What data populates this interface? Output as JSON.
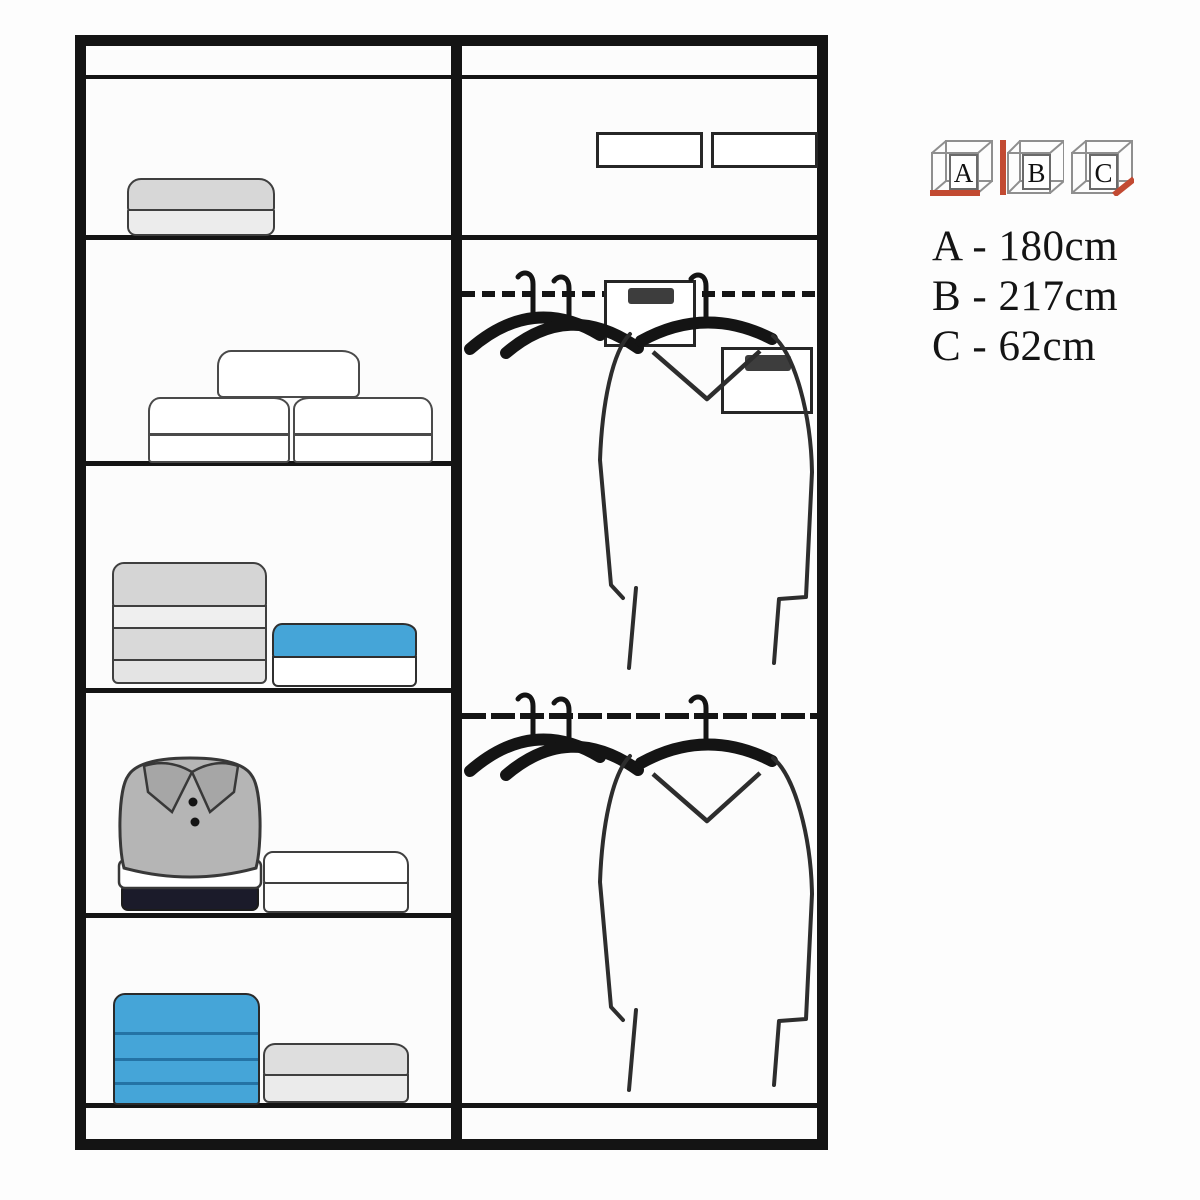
{
  "legend": {
    "cubes": [
      {
        "letter": "A"
      },
      {
        "letter": "B"
      },
      {
        "letter": "C"
      }
    ],
    "measurements": [
      {
        "text": "A - 180cm"
      },
      {
        "text": "B - 217cm"
      },
      {
        "text": "C - 62cm"
      }
    ]
  },
  "colors": {
    "outline": "#141414",
    "accent_blue": "#45a5d8",
    "accent_blue_dark": "#2473a5",
    "highlight_red": "#c24a32",
    "polo_gray": "#b5b5b5",
    "collar_gray": "#a6a6a6",
    "navy": "#1b1b2a",
    "item_gray": "#d7d7d7",
    "item_gray_light": "#ececec"
  }
}
